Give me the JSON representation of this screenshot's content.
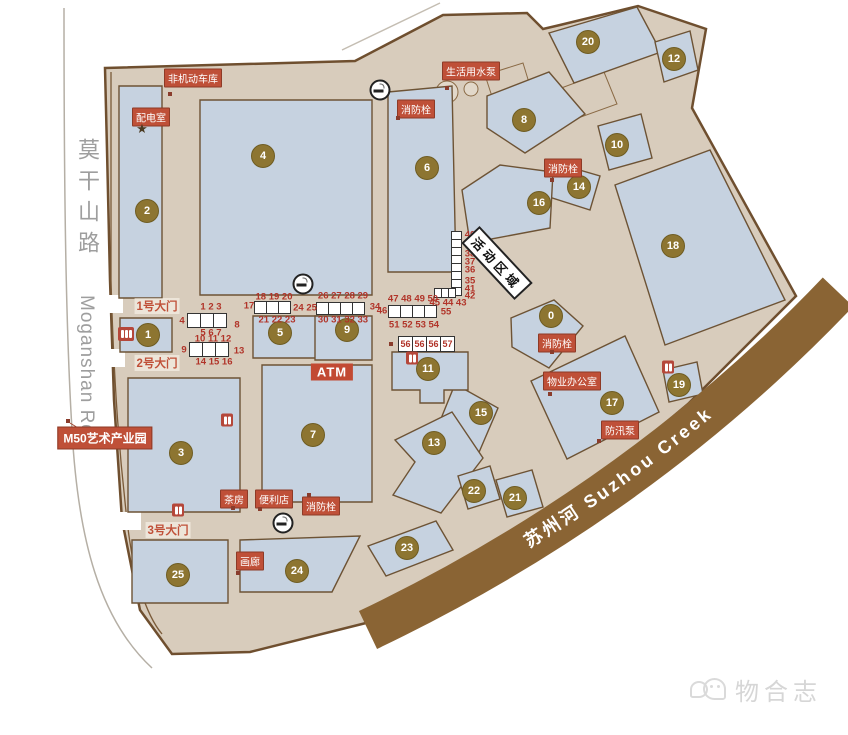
{
  "map": {
    "road": {
      "name_cn": "莫干山路",
      "name_en": "Moganshan Rd."
    },
    "creek": {
      "label": "苏州河   Suzhou Creek"
    },
    "buildings": [
      {
        "id": "0",
        "x": 551,
        "y": 316
      },
      {
        "id": "1",
        "x": 148,
        "y": 335
      },
      {
        "id": "2",
        "x": 147,
        "y": 211
      },
      {
        "id": "3",
        "x": 181,
        "y": 453
      },
      {
        "id": "4",
        "x": 263,
        "y": 156
      },
      {
        "id": "5",
        "x": 280,
        "y": 333
      },
      {
        "id": "6",
        "x": 427,
        "y": 168
      },
      {
        "id": "7",
        "x": 313,
        "y": 435
      },
      {
        "id": "8",
        "x": 524,
        "y": 120
      },
      {
        "id": "9",
        "x": 347,
        "y": 330
      },
      {
        "id": "10",
        "x": 617,
        "y": 145
      },
      {
        "id": "11",
        "x": 428,
        "y": 369
      },
      {
        "id": "12",
        "x": 674,
        "y": 59
      },
      {
        "id": "13",
        "x": 434,
        "y": 443
      },
      {
        "id": "14",
        "x": 579,
        "y": 187
      },
      {
        "id": "15",
        "x": 481,
        "y": 413
      },
      {
        "id": "16",
        "x": 539,
        "y": 203
      },
      {
        "id": "17",
        "x": 612,
        "y": 403
      },
      {
        "id": "18",
        "x": 673,
        "y": 246
      },
      {
        "id": "19",
        "x": 679,
        "y": 385
      },
      {
        "id": "20",
        "x": 588,
        "y": 42
      },
      {
        "id": "21",
        "x": 515,
        "y": 498
      },
      {
        "id": "22",
        "x": 474,
        "y": 491
      },
      {
        "id": "23",
        "x": 407,
        "y": 548
      },
      {
        "id": "24",
        "x": 297,
        "y": 571
      },
      {
        "id": "25",
        "x": 178,
        "y": 575
      }
    ],
    "facilities": [
      {
        "name": "label-non-motor-garage",
        "kind": "red",
        "text": "非机动车库",
        "x": 193,
        "y": 78
      },
      {
        "name": "label-power-room",
        "kind": "red",
        "text": "配电室",
        "x": 151,
        "y": 117
      },
      {
        "name": "label-water-pump",
        "kind": "red",
        "text": "生活用水泵",
        "x": 471,
        "y": 71
      },
      {
        "name": "label-fire-hydrant-1",
        "kind": "red",
        "text": "消防栓",
        "x": 416,
        "y": 109
      },
      {
        "name": "label-fire-hydrant-2",
        "kind": "red",
        "text": "消防栓",
        "x": 563,
        "y": 168
      },
      {
        "name": "label-fire-hydrant-3",
        "kind": "red",
        "text": "消防栓",
        "x": 557,
        "y": 343
      },
      {
        "name": "label-property-office",
        "kind": "red",
        "text": "物业办公室",
        "x": 572,
        "y": 381
      },
      {
        "name": "label-flood-pump",
        "kind": "red",
        "text": "防汛泵",
        "x": 620,
        "y": 430
      },
      {
        "name": "label-fire-hydrant-4",
        "kind": "red",
        "text": "消防栓",
        "x": 321,
        "y": 506
      },
      {
        "name": "label-tea-house",
        "kind": "red",
        "text": "茶房",
        "x": 234,
        "y": 499
      },
      {
        "name": "label-convenience-store",
        "kind": "red",
        "text": "便利店",
        "x": 274,
        "y": 499
      },
      {
        "name": "label-gallery",
        "kind": "red",
        "text": "画廊",
        "x": 250,
        "y": 561
      },
      {
        "name": "label-m50-park",
        "kind": "m50",
        "text": "M50艺术产业园",
        "x": 105,
        "y": 438
      },
      {
        "name": "label-gate-1",
        "kind": "gate",
        "text": "1号大门",
        "x": 157,
        "y": 306
      },
      {
        "name": "label-gate-2",
        "kind": "gate",
        "text": "2号大门",
        "x": 157,
        "y": 363
      },
      {
        "name": "label-gate-3",
        "kind": "gate",
        "text": "3号大门",
        "x": 168,
        "y": 530
      },
      {
        "name": "label-atm",
        "kind": "atm",
        "text": "ATM",
        "x": 332,
        "y": 372
      },
      {
        "name": "label-activity-area",
        "kind": "activity",
        "text": "活动区域",
        "x": 497,
        "y": 263
      }
    ],
    "stall_numbers": [
      {
        "t": "1 2 3",
        "x": 211,
        "y": 307
      },
      {
        "t": "4",
        "x": 182,
        "y": 321
      },
      {
        "t": "8",
        "x": 237,
        "y": 325
      },
      {
        "t": "5 6 7",
        "x": 211,
        "y": 333
      },
      {
        "t": "10 11 12",
        "x": 213,
        "y": 339
      },
      {
        "t": "9",
        "x": 184,
        "y": 350
      },
      {
        "t": "13",
        "x": 239,
        "y": 351
      },
      {
        "t": "14 15 16",
        "x": 214,
        "y": 362
      },
      {
        "t": "17",
        "x": 249,
        "y": 306
      },
      {
        "t": "18 19 20",
        "x": 274,
        "y": 297
      },
      {
        "t": "21 22 23",
        "x": 277,
        "y": 320
      },
      {
        "t": "24 25",
        "x": 305,
        "y": 308
      },
      {
        "t": "26 27 28 29",
        "x": 343,
        "y": 296
      },
      {
        "t": "30 31 32 33",
        "x": 343,
        "y": 320
      },
      {
        "t": "34",
        "x": 375,
        "y": 307
      },
      {
        "t": "47 48 49 50",
        "x": 413,
        "y": 299
      },
      {
        "t": "46",
        "x": 382,
        "y": 311
      },
      {
        "t": "55",
        "x": 446,
        "y": 312
      },
      {
        "t": "51 52 53 54",
        "x": 414,
        "y": 325
      },
      {
        "t": "40",
        "x": 470,
        "y": 235
      },
      {
        "t": "39",
        "x": 470,
        "y": 246
      },
      {
        "t": "38",
        "x": 470,
        "y": 254
      },
      {
        "t": "37",
        "x": 470,
        "y": 262
      },
      {
        "t": "36",
        "x": 470,
        "y": 270
      },
      {
        "t": "35",
        "x": 470,
        "y": 281
      },
      {
        "t": "41",
        "x": 470,
        "y": 289
      },
      {
        "t": "42",
        "x": 470,
        "y": 296
      },
      {
        "t": "45 44 43",
        "x": 448,
        "y": 303
      }
    ],
    "stall_boxes": [
      {
        "x": 187,
        "y": 313,
        "cells": 3,
        "cw": 14,
        "ch": 15
      },
      {
        "x": 189,
        "y": 342,
        "cells": 3,
        "cw": 14,
        "ch": 15
      },
      {
        "x": 254,
        "y": 301,
        "cells": 3,
        "cw": 13,
        "ch": 13
      },
      {
        "x": 316,
        "y": 302,
        "cells": 4,
        "cw": 13,
        "ch": 13
      },
      {
        "x": 388,
        "y": 305,
        "cells": 4,
        "cw": 13,
        "ch": 13
      },
      {
        "x": 398,
        "y": 336,
        "cells": 4,
        "cw": 15,
        "ch": 16,
        "values": [
          "56",
          "56",
          "56",
          "57"
        ]
      },
      {
        "x": 451,
        "y": 231,
        "cells": 8,
        "cw": 11,
        "ch": 9,
        "vertical": true
      },
      {
        "x": 434,
        "y": 288,
        "cells": 3,
        "cw": 8,
        "ch": 10
      }
    ],
    "icons": [
      {
        "name": "smoking-area-icon",
        "x": 380,
        "y": 90
      },
      {
        "name": "smoking-area-icon",
        "x": 303,
        "y": 284
      },
      {
        "name": "smoking-area-icon",
        "x": 283,
        "y": 523
      },
      {
        "name": "toilet-icon",
        "x": 227,
        "y": 420
      },
      {
        "name": "toilet-icon",
        "x": 178,
        "y": 510
      },
      {
        "name": "toilet-icon",
        "x": 412,
        "y": 358
      },
      {
        "name": "toilet-icon",
        "x": 668,
        "y": 367
      },
      {
        "name": "turnstile-icon",
        "x": 126,
        "y": 334
      },
      {
        "name": "power-star-icon",
        "x": 142,
        "y": 129
      }
    ],
    "dots": [
      {
        "x": 170,
        "y": 94
      },
      {
        "x": 398,
        "y": 118
      },
      {
        "x": 447,
        "y": 88
      },
      {
        "x": 552,
        "y": 180
      },
      {
        "x": 552,
        "y": 352
      },
      {
        "x": 550,
        "y": 394
      },
      {
        "x": 599,
        "y": 441
      },
      {
        "x": 309,
        "y": 495
      },
      {
        "x": 233,
        "y": 508
      },
      {
        "x": 260,
        "y": 509
      },
      {
        "x": 238,
        "y": 573
      },
      {
        "x": 68,
        "y": 421
      },
      {
        "x": 391,
        "y": 344
      }
    ],
    "colors": {
      "park": "#d8ccbc",
      "building": "#c6d2e0",
      "creek": "#8a6434",
      "badge_gold": "#8d7531",
      "label_red": "#bf5038",
      "number_red": "#b13429",
      "outline_brown": "#7a5a38"
    }
  },
  "watermark": {
    "text": "物合志"
  }
}
